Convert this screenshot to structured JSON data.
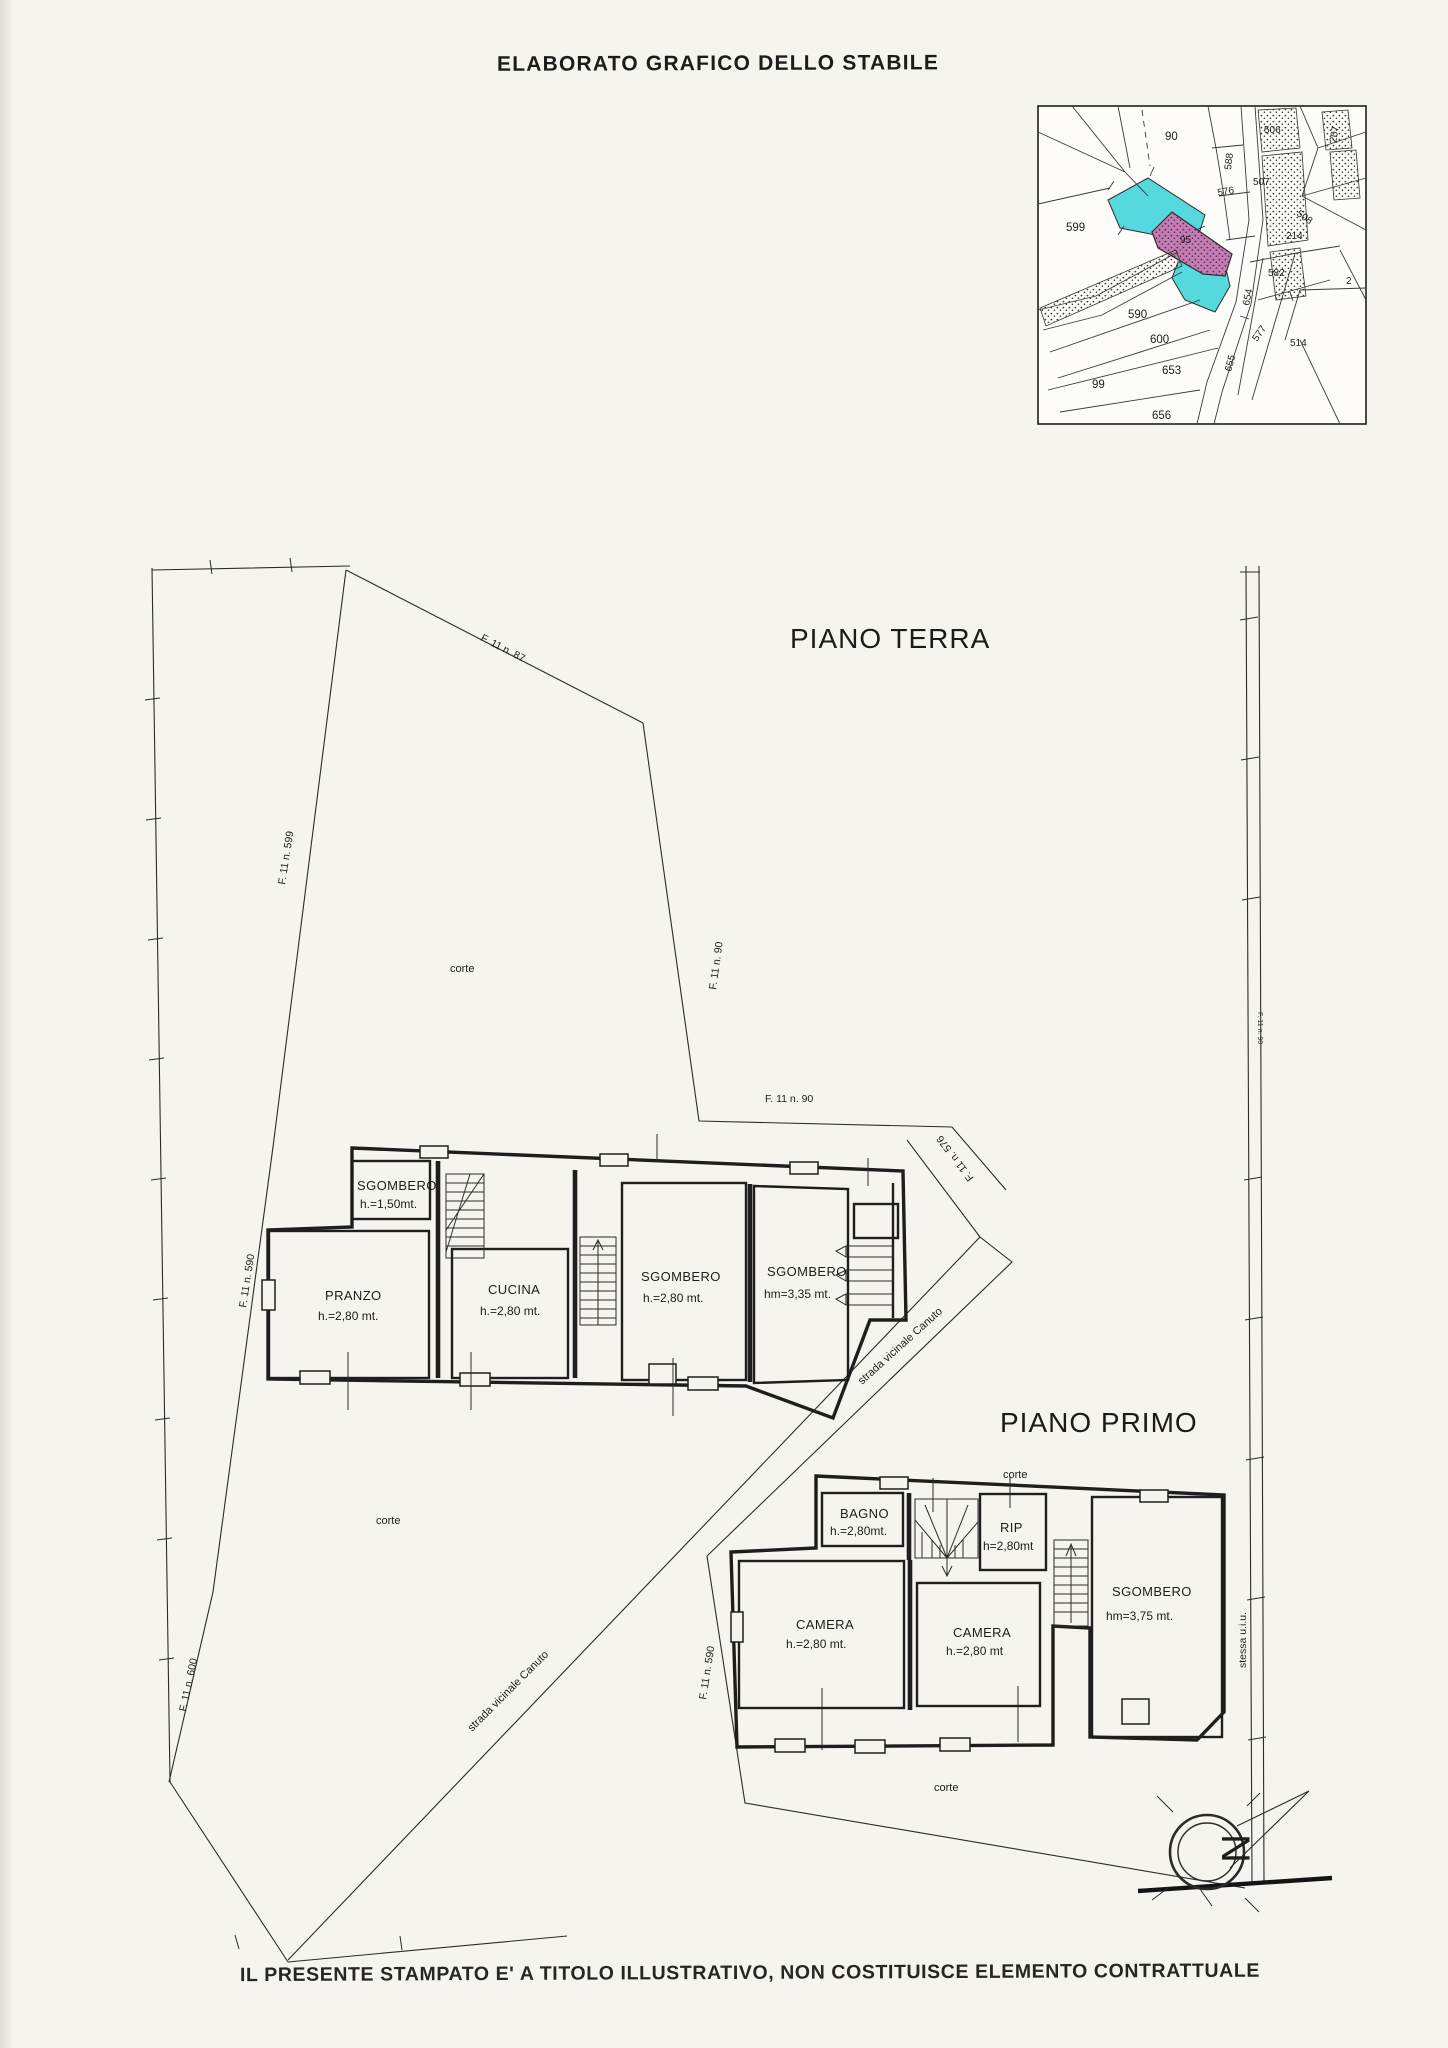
{
  "document": {
    "title": "ELABORATO GRAFICO DELLO STABILE",
    "disclaimer": "IL PRESENTE STAMPATO E' A TITOLO ILLUSTRATIVO, NON COSTITUISCE ELEMENTO CONTRATTUALE"
  },
  "minimap": {
    "parcels": [
      "90",
      "588",
      "576",
      "506",
      "507",
      "508",
      "207",
      "214",
      "599",
      "95",
      "582",
      "654",
      "577",
      "514",
      "2",
      "590",
      "600",
      "653",
      "99",
      "655",
      "656"
    ],
    "colors": {
      "highlight_cyan": "#55d8de",
      "subject_pink": "#c77ab5"
    }
  },
  "site": {
    "floors": {
      "ground": "PIANO TERRA",
      "first": "PIANO PRIMO"
    },
    "labels": {
      "corte": "corte",
      "road": "strada vicinale Canuto",
      "f87": "F. 11 n. 87",
      "f599": "F. 11 n. 599",
      "f90": "F. 11 n. 90",
      "f576": "F. 11 n. 576",
      "f590": "F. 11 n. 590",
      "f600": "F. 11 n. 600",
      "same_unit": "stessa u.i.u.",
      "north": "N"
    }
  },
  "ground_floor": {
    "rooms": [
      {
        "name": "SGOMBERO",
        "height": "h.=1,50mt."
      },
      {
        "name": "PRANZO",
        "height": "h.=2,80 mt."
      },
      {
        "name": "CUCINA",
        "height": "h.=2,80 mt."
      },
      {
        "name": "SGOMBERO",
        "height": "h.=2,80 mt."
      },
      {
        "name": "SGOMBERO",
        "height": "hm=3,35 mt."
      }
    ]
  },
  "first_floor": {
    "rooms": [
      {
        "name": "BAGNO",
        "height": "h.=2,80mt."
      },
      {
        "name": "RIP",
        "height": "h=2,80mt"
      },
      {
        "name": "CAMERA",
        "height": "h.=2,80 mt."
      },
      {
        "name": "CAMERA",
        "height": "h.=2,80 mt"
      },
      {
        "name": "SGOMBERO",
        "height": "hm=3,75 mt."
      }
    ]
  },
  "colors": {
    "paper": "#f6f4ef",
    "ink": "#202020"
  }
}
